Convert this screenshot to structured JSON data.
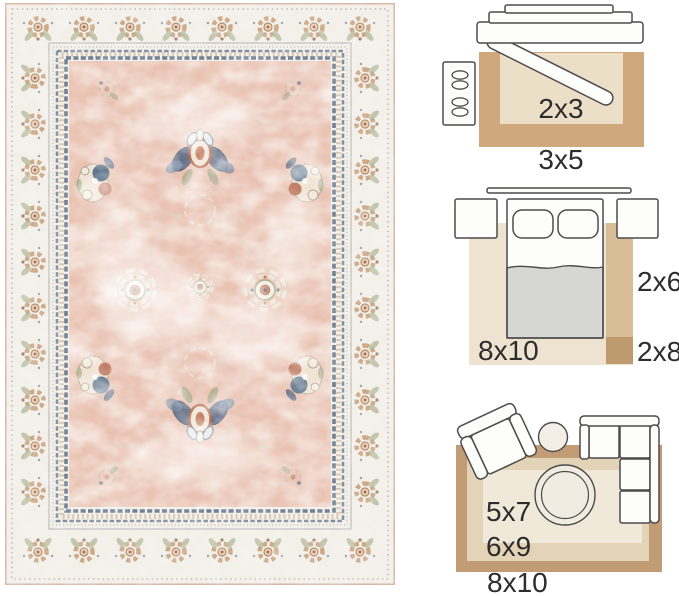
{
  "page": {
    "background": "#ffffff",
    "description": "Area rug product photo with rug size guide diagrams"
  },
  "rug_photo": {
    "style": "distressed vintage floral area rug",
    "colors": {
      "field_pink": "#e9c2b1",
      "border_ivory": "#f3f0ea",
      "accent_navy": "#4a5f7e",
      "accent_rust": "#b5694c",
      "accent_tan": "#cda988",
      "accent_sage": "#9aa37f",
      "edge_line": "#d8b6a5",
      "guard_navy": "#5d6f87"
    }
  },
  "size_guide": {
    "label_color": "#2d2d2d",
    "palette": {
      "rug_light": "#f0e9da",
      "rug_cream": "#ecdfc8",
      "rug_beige": "#eee3d1",
      "rug_mid_tan": "#e3d3b7",
      "rug_tan": "#d9bd97",
      "rug_dark_tan": "#c19c74",
      "rug_warm_tan": "#d0a87e",
      "runner_dark": "#bf9a6f",
      "furniture_outline": "#4c4c4c",
      "furniture_fill": "#fdfdfb",
      "blanket_gray": "#d6d6d5"
    },
    "diagrams": [
      {
        "room": "entryway",
        "sizes": [
          "2x3",
          "3x5"
        ]
      },
      {
        "room": "bedroom",
        "sizes": [
          "8x10",
          "2x6",
          "2x8"
        ]
      },
      {
        "room": "living-room",
        "sizes": [
          "5x7",
          "6x9",
          "8x10"
        ]
      }
    ]
  }
}
